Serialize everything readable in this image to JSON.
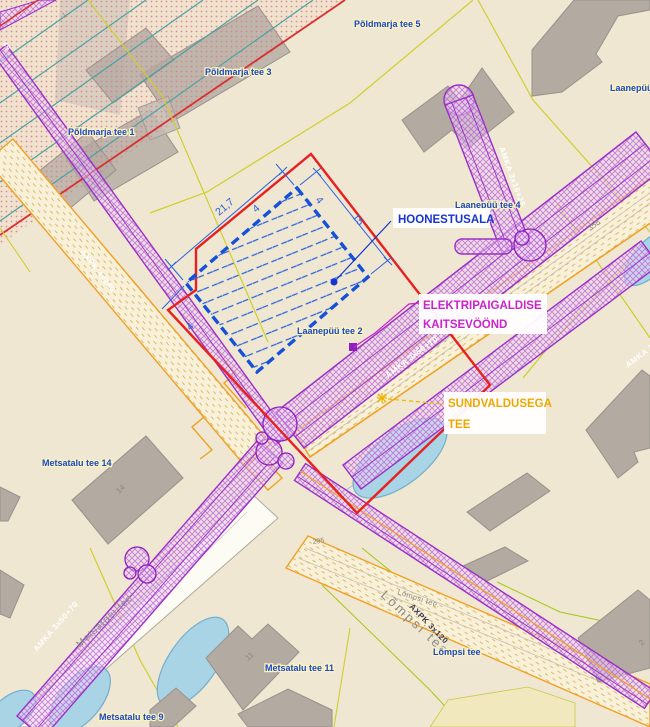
{
  "annotations": {
    "hoonestusala": {
      "label": "HOONESTUSALA",
      "color": "#1535cf"
    },
    "kaitsevoond": {
      "line1": "ELEKTRIPAIGALDISE",
      "line2": "KAITSEVÖÖND",
      "color": "#cc22cc"
    },
    "sundvaldus": {
      "line1": "SUNDVALDUSEGA",
      "line2": "TEE",
      "color": "#f0a800"
    }
  },
  "dimension_labels": {
    "side_a": "21,7",
    "side_b": "15",
    "offset_a": "4",
    "offset_b": "4",
    "offset_c": "4"
  },
  "street_labels": [
    {
      "id": "poldmarja-5",
      "text": "Põldmarja tee 5"
    },
    {
      "id": "poldmarja-3",
      "text": "Põldmarja tee 3"
    },
    {
      "id": "poldmarja-1",
      "text": "Põldmarja tee 1"
    },
    {
      "id": "laanepuu-6",
      "text": "Laanepüü tee 6"
    },
    {
      "id": "laanepuu-4",
      "text": "Laanepüü tee 4"
    },
    {
      "id": "laanepuu-2",
      "text": "Laanepüü tee 2"
    },
    {
      "id": "metsatalu-14",
      "text": "Metsatalu tee 14"
    },
    {
      "id": "metsatalu-11",
      "text": "Metsatalu tee 11"
    },
    {
      "id": "metsatalu-9",
      "text": "Metsatalu tee 9"
    },
    {
      "id": "lompsi-blue",
      "text": "Lõmpsi tee"
    }
  ],
  "cable_labels": [
    {
      "id": "axpk-4x240",
      "text": "AXPK 4x240"
    },
    {
      "id": "amka-3x16-25",
      "text": "AMKA 3x16+25"
    },
    {
      "id": "amka-3x50-70-mid",
      "text": "AMKA 3x50+70"
    },
    {
      "id": "amka-3x50-70-sw",
      "text": "AMKA 3x50+70"
    },
    {
      "id": "axpk-3x120",
      "text": "AXPK 3x120"
    },
    {
      "id": "amka-3x50-70-edge",
      "text": "AMKA 3x50+70"
    },
    {
      "id": "corner-partial",
      "text": "49"
    }
  ],
  "road_labels": [
    {
      "id": "metsatalu-tee",
      "text": "Metsatalu tee"
    },
    {
      "id": "lompsi-tee-large",
      "text": "Lõmpsi tee"
    },
    {
      "id": "lompsi-tee-small",
      "text": "Lõmpsi tee."
    }
  ],
  "parcel_numbers": [
    {
      "id": "n358",
      "text": "358"
    },
    {
      "id": "n295",
      "text": "295"
    },
    {
      "id": "n14",
      "text": "14"
    },
    {
      "id": "n11",
      "text": "11"
    },
    {
      "id": "n2",
      "text": "2"
    },
    {
      "id": "n1",
      "text": "1"
    }
  ],
  "colors": {
    "background": "#efe7d1",
    "boundary_red": "#e82020",
    "building_area_blue": "#1550d8",
    "corridor_purple": "#9b30c8",
    "pond_blue": "#a9d4e6",
    "cadastral_yellow": "#cfcf2e",
    "road_orange": "#f0a125",
    "annotation_blue": "#1535cf",
    "annotation_magenta": "#cc22cc",
    "annotation_yellow": "#f0a800"
  }
}
